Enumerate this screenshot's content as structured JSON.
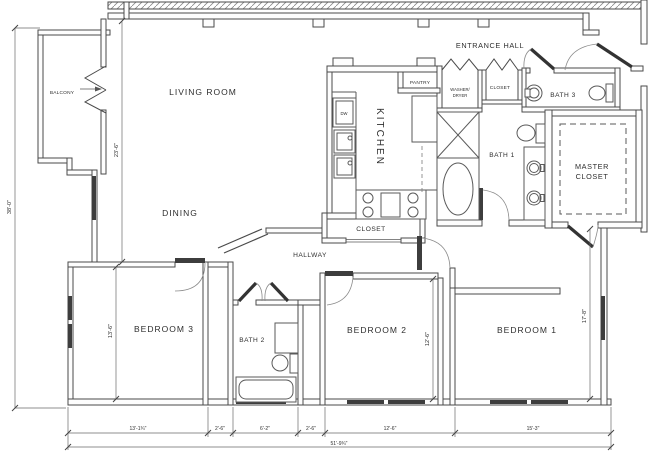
{
  "rooms": {
    "balcony": "BALCONY",
    "living_room": "LIVING ROOM",
    "dining": "DINING",
    "kitchen": "KITCHEN",
    "entrance_hall": "ENTRANCE HALL",
    "pantry": "PANTRY",
    "washer_dryer_line1": "WASHER/",
    "washer_dryer_line2": "DRYER",
    "entry_closet": "CLOSET",
    "bath3": "BATH 3",
    "bath1": "BATH 1",
    "master_closet_line1": "MASTER",
    "master_closet_line2": "CLOSET",
    "hall_closet": "CLOSET",
    "hallway": "HALLWAY",
    "bedroom3": "BEDROOM 3",
    "bath2": "BATH 2",
    "bedroom2": "BEDROOM 2",
    "bedroom1": "BEDROOM 1"
  },
  "fixtures": {
    "dishwasher": "DW"
  },
  "dimensions": {
    "overall_height": "38'-0\"",
    "living_zone_height": "23'-6\"",
    "bedroom3_height": "13'-6\"",
    "bedroom2_height": "12'-6\"",
    "bedroom1_height": "17'-8\"",
    "bottom_segments": [
      "13'-1¾\"",
      "2'-6\"",
      "6'-2\"",
      "2'-6\"",
      "12'-6\"",
      "15'-3\""
    ],
    "overall_width": "51'-9¾\""
  }
}
